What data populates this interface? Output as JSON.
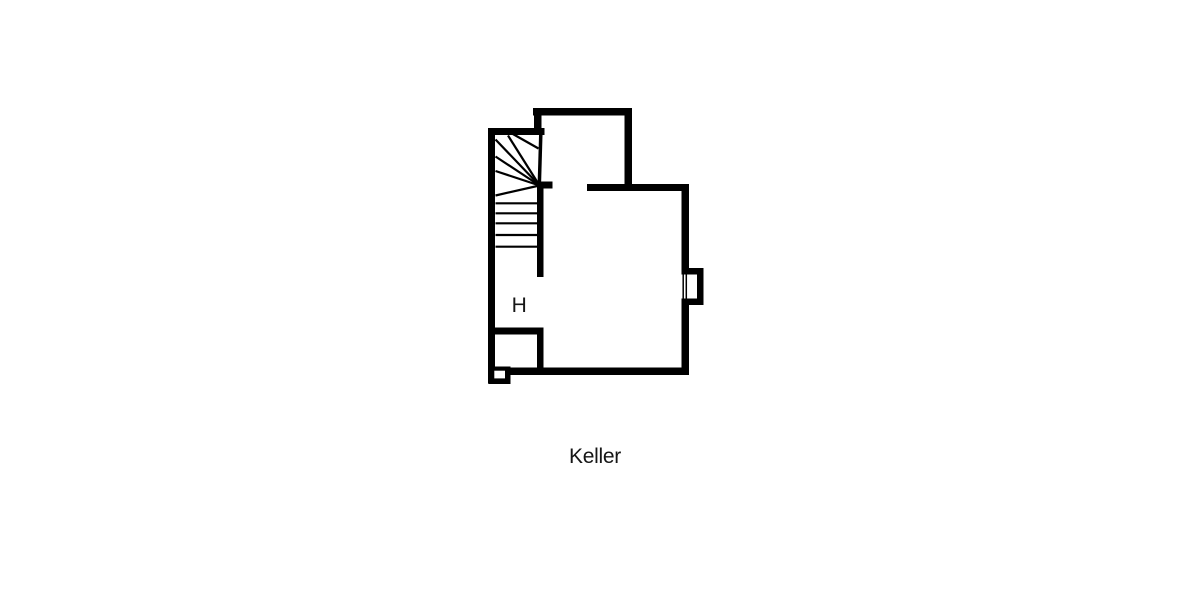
{
  "canvas": {
    "width": 1200,
    "height": 600,
    "background": "#ffffff"
  },
  "plan": {
    "ink": "#000000",
    "background": "#ffffff",
    "label_color": "#161616",
    "room_label": "H",
    "caption": "Keller",
    "walls": [
      {
        "name": "top-wall",
        "x": 533,
        "y": 108,
        "w": 99,
        "h": 7.5
      },
      {
        "name": "notch-vertical-wall",
        "x": 534,
        "y": 108,
        "w": 7.5,
        "h": 27
      },
      {
        "name": "notch-wall",
        "x": 488,
        "y": 128,
        "w": 56.5,
        "h": 7
      },
      {
        "name": "left-wall",
        "x": 488,
        "y": 128,
        "w": 7,
        "h": 255.5
      },
      {
        "name": "top-right-vertical-wall",
        "x": 624.5,
        "y": 108,
        "w": 7.5,
        "h": 82.5
      },
      {
        "name": "main-room-top-wall",
        "x": 587,
        "y": 184,
        "w": 101.5,
        "h": 7
      },
      {
        "name": "right-wall",
        "x": 681.5,
        "y": 184,
        "w": 7.5,
        "h": 191
      },
      {
        "name": "bottom-wall",
        "x": 509,
        "y": 367.5,
        "w": 180,
        "h": 7.5
      },
      {
        "name": "stair-door-stub-wall",
        "x": 537,
        "y": 181.5,
        "w": 15.5,
        "h": 7
      },
      {
        "name": "stair-right-wall",
        "x": 537,
        "y": 185,
        "w": 6.5,
        "h": 92
      },
      {
        "name": "small-room-top-wall",
        "x": 488,
        "y": 327.5,
        "w": 55.5,
        "h": 7
      },
      {
        "name": "small-room-right-wall",
        "x": 537,
        "y": 327.5,
        "w": 6.5,
        "h": 46.5
      },
      {
        "name": "corner-shaft-box",
        "x": 488.5,
        "y": 366.5,
        "w": 22,
        "h": 17.5
      },
      {
        "name": "window-sill-top",
        "x": 681.5,
        "y": 268,
        "w": 22,
        "h": 6.5
      },
      {
        "name": "window-sill-right",
        "x": 697,
        "y": 268,
        "w": 6.5,
        "h": 37
      },
      {
        "name": "window-sill-bottom",
        "x": 681.5,
        "y": 298.5,
        "w": 22,
        "h": 6.5
      }
    ],
    "openings": [
      {
        "name": "window-opening",
        "x": 681.2,
        "y": 274.5,
        "w": 8.5,
        "h": 24
      },
      {
        "name": "corner-shaft-inner",
        "x": 494.3,
        "y": 370.7,
        "w": 10.7,
        "h": 7.7
      }
    ],
    "lines": [
      {
        "name": "window-glazing-line-1",
        "x1": 683.2,
        "y1": 274.5,
        "x2": 683.2,
        "y2": 298.5,
        "w": 1.5
      },
      {
        "name": "window-glazing-line-2",
        "x1": 686.3,
        "y1": 274.5,
        "x2": 686.3,
        "y2": 298.5,
        "w": 1.5
      },
      {
        "name": "stair-winder-line-1",
        "x1": 539.5,
        "y1": 185.5,
        "x2": 508,
        "y2": 135.5,
        "w": 2.2
      },
      {
        "name": "stair-winder-line-2",
        "x1": 539.5,
        "y1": 185.5,
        "x2": 495.5,
        "y2": 139.5,
        "w": 2.2
      },
      {
        "name": "stair-winder-line-3",
        "x1": 539.5,
        "y1": 185.5,
        "x2": 495.5,
        "y2": 156.5,
        "w": 2.2
      },
      {
        "name": "stair-winder-line-4",
        "x1": 539.5,
        "y1": 185.5,
        "x2": 495.5,
        "y2": 171,
        "w": 2.2
      },
      {
        "name": "stair-winder-line-5",
        "x1": 539.5,
        "y1": 185.5,
        "x2": 495.5,
        "y2": 195.5,
        "w": 2.2
      },
      {
        "name": "stair-winder-line-6",
        "x1": 512,
        "y1": 133.5,
        "x2": 538.5,
        "y2": 148.5,
        "w": 2.2
      },
      {
        "name": "stair-newel-edge",
        "x1": 540.8,
        "y1": 134,
        "x2": 539.3,
        "y2": 185.5,
        "w": 3.5
      },
      {
        "name": "stair-tread-1",
        "x1": 495.5,
        "y1": 203.3,
        "x2": 537,
        "y2": 203.3,
        "w": 2.2
      },
      {
        "name": "stair-tread-2",
        "x1": 495.5,
        "y1": 213.3,
        "x2": 537,
        "y2": 213.3,
        "w": 2.2
      },
      {
        "name": "stair-tread-3",
        "x1": 495.5,
        "y1": 223.3,
        "x2": 537,
        "y2": 223.3,
        "w": 2.2
      },
      {
        "name": "stair-tread-4",
        "x1": 495.5,
        "y1": 235,
        "x2": 537,
        "y2": 235,
        "w": 2.2
      },
      {
        "name": "stair-tread-5",
        "x1": 495.5,
        "y1": 246.7,
        "x2": 537,
        "y2": 246.7,
        "w": 2.2
      }
    ]
  }
}
